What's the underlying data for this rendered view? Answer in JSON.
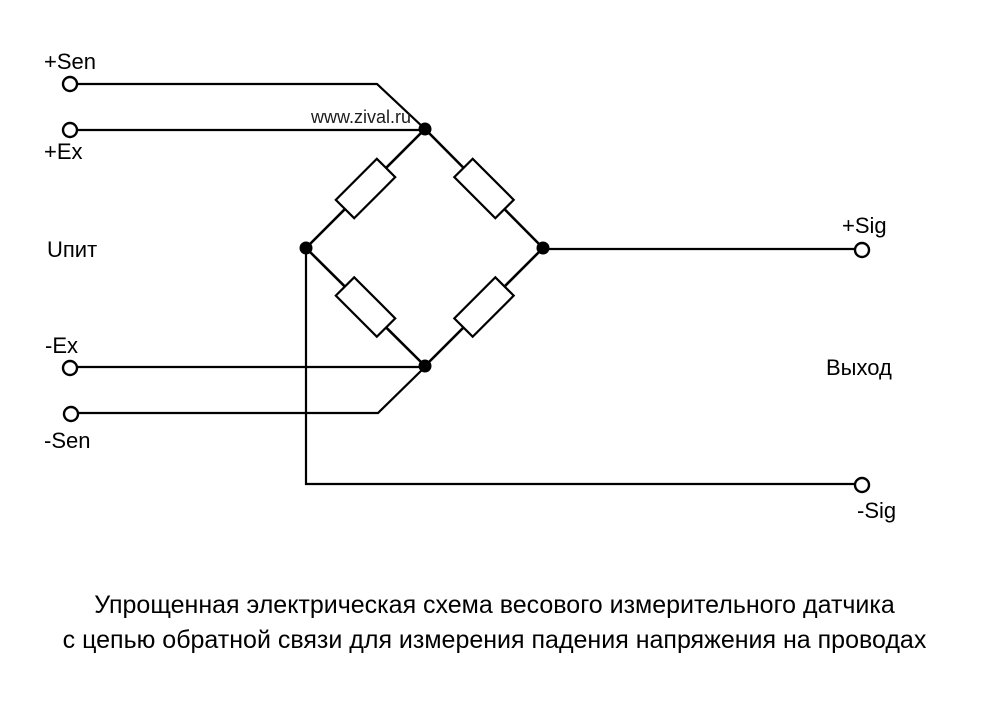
{
  "diagram": {
    "title_hint": "Load cell Wheatstone bridge schematic",
    "watermark": "www.zival.ru",
    "labels": {
      "sen_plus": "+Sen",
      "ex_plus": "+Ex",
      "supply": "Uпит",
      "ex_minus": "-Ex",
      "sen_minus": "-Sen",
      "sig_plus": "+Sig",
      "output": "Выход",
      "sig_minus": "-Sig"
    },
    "caption": {
      "line1": "Упрощенная электрическая схема весового измерительного датчика",
      "line2": "с цепью обратной связи для измерения падения напряжения на проводах"
    },
    "colors": {
      "line": "#000000",
      "background": "#ffffff",
      "watermark_text": "#1c1c1c"
    }
  }
}
